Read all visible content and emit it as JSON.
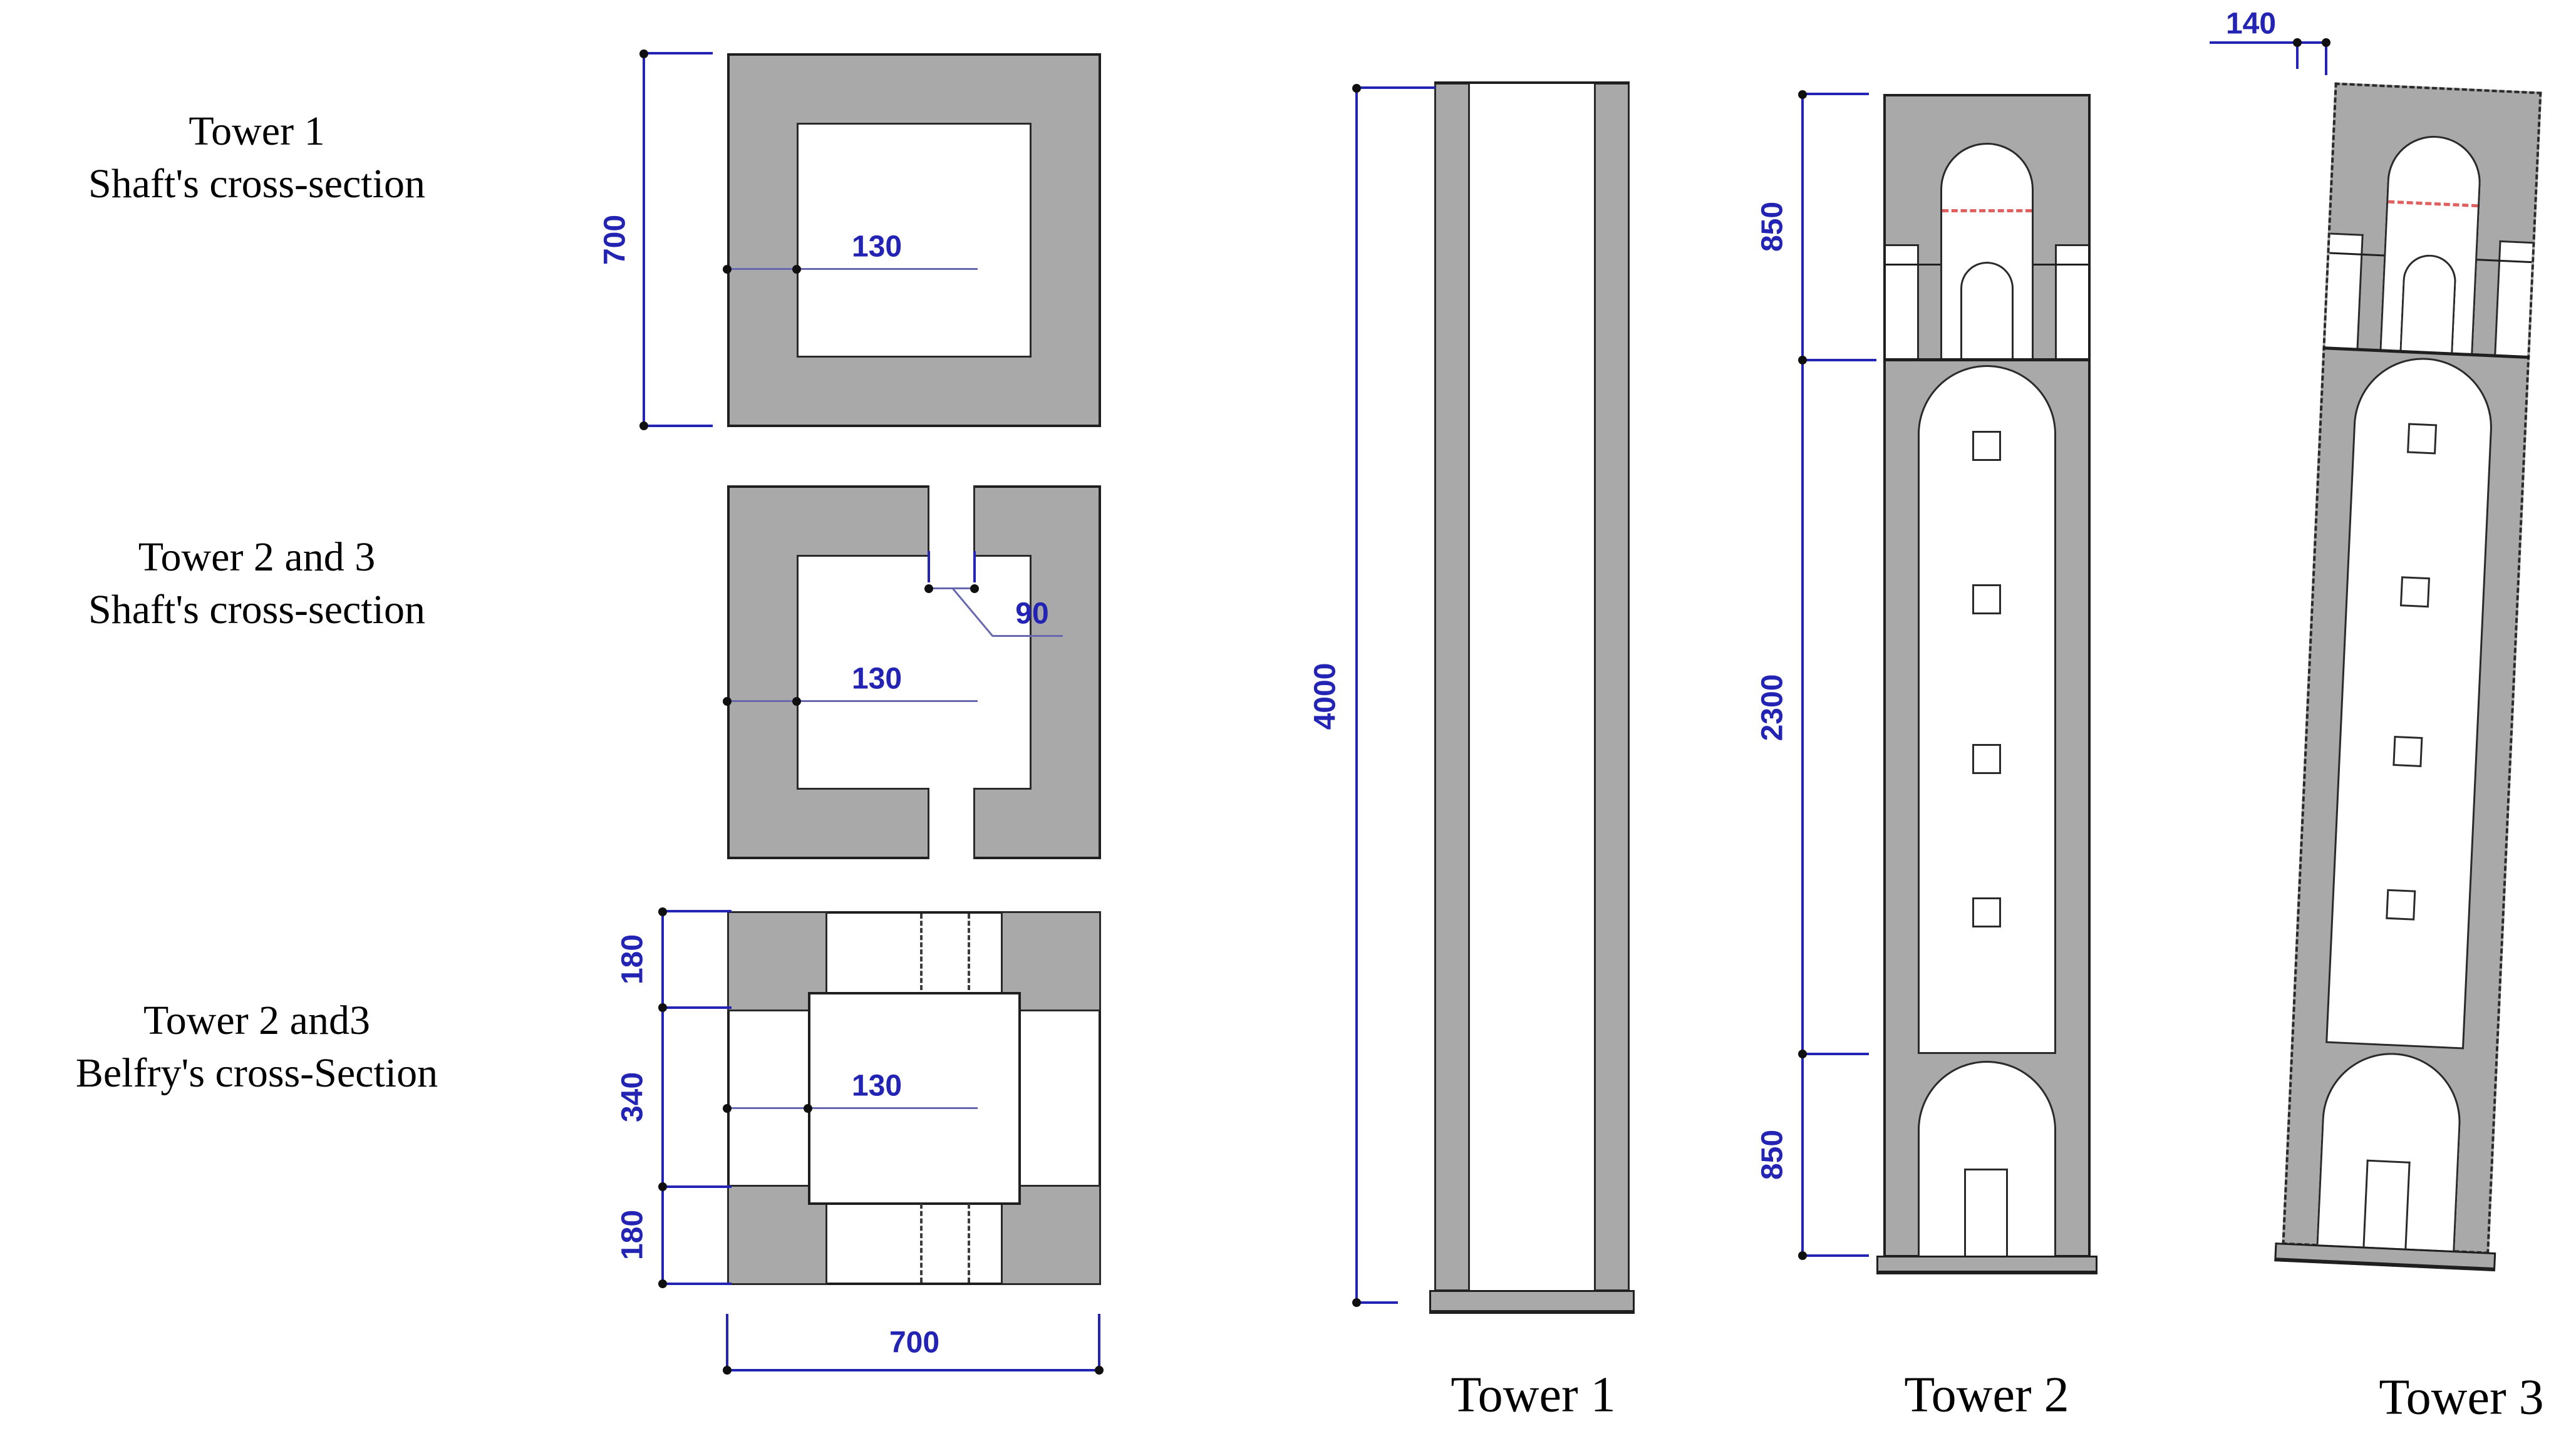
{
  "figure": {
    "left_labels": [
      {
        "line1": "Tower 1",
        "line2": "Shaft's cross-section"
      },
      {
        "line1": "Tower 2 and 3",
        "line2": "Shaft's cross-section"
      },
      {
        "line1": "Tower 2 and3",
        "line2": "Belfry's cross-Section"
      }
    ],
    "cross_section_1": {
      "height": "700",
      "wall_thickness": "130"
    },
    "cross_section_2": {
      "wall_thickness": "130",
      "slot_width": "90"
    },
    "cross_section_3": {
      "corner_depth_top": "180",
      "opening_width": "340",
      "corner_depth_bottom": "180",
      "wall_thickness": "130",
      "width": "700"
    },
    "tower_1": {
      "label": "Tower 1",
      "height": "4000"
    },
    "tower_2": {
      "label": "Tower 2",
      "belfry_height": "850",
      "shaft_height": "2300",
      "base_height": "850"
    },
    "tower_3": {
      "label": "Tower 3",
      "lean_offset": "140"
    },
    "colors": {
      "masonry_gray": "#a9a9a9",
      "dimension_blue": "#2323b4",
      "crack_red": "#e06060",
      "outline_dark": "#1f1f1f"
    }
  }
}
